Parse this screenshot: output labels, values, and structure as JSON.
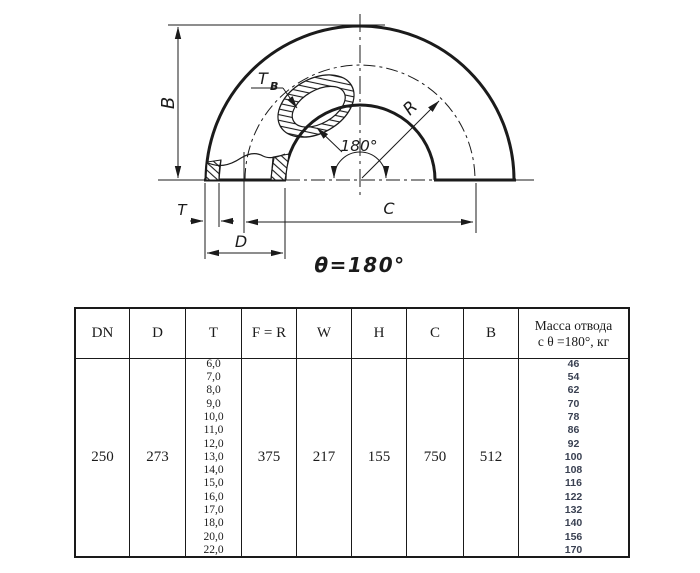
{
  "diagram": {
    "labels": {
      "b": "B",
      "t": "T",
      "d": "D",
      "c": "C",
      "r": "R",
      "tb_main": "T",
      "tb_sub": "B",
      "angle": "180°",
      "theta_note": "θ=180°"
    }
  },
  "table": {
    "headers": [
      "DN",
      "D",
      "T",
      "F = R",
      "W",
      "H",
      "C",
      "B"
    ],
    "mass_header_line1": "Масса отвода",
    "mass_header_line2": "с θ =180°, кг",
    "row": {
      "dn": "250",
      "d": "273",
      "t_values": [
        "6,0",
        "7,0",
        "8,0",
        "9,0",
        "10,0",
        "11,0",
        "12,0",
        "13,0",
        "14,0",
        "15,0",
        "16,0",
        "17,0",
        "18,0",
        "20,0",
        "22,0"
      ],
      "f_r": "375",
      "w": "217",
      "h": "155",
      "c": "750",
      "b": "512",
      "mass_values": [
        "46",
        "54",
        "62",
        "70",
        "78",
        "86",
        "92",
        "100",
        "108",
        "116",
        "122",
        "132",
        "140",
        "156",
        "170"
      ]
    }
  },
  "colors": {
    "ink": "#1b1b1b",
    "mass_text": "#3a4152"
  }
}
